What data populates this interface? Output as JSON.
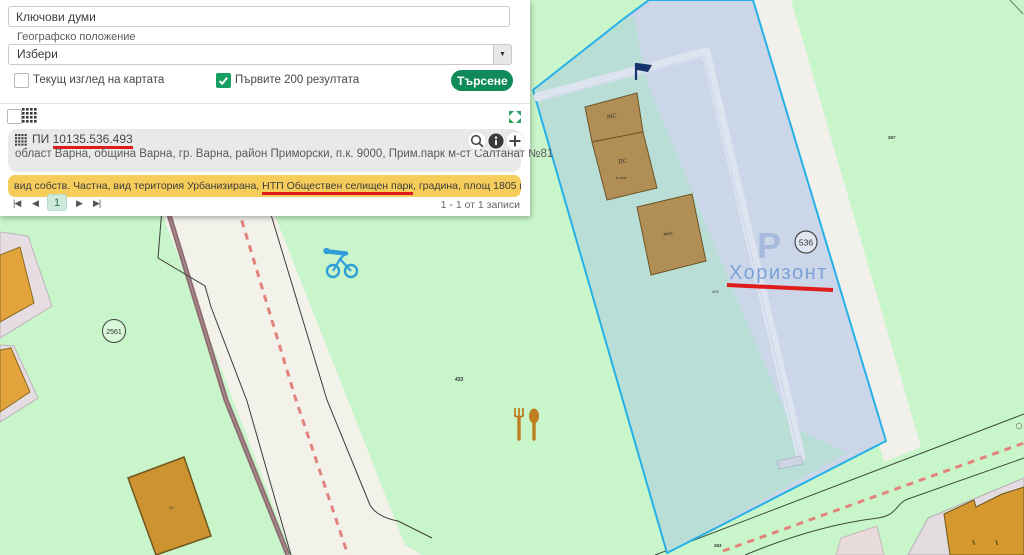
{
  "colors": {
    "accent_green": "#0f8a58",
    "selection_blue_fill": "#cbd7e9",
    "selection_border_cyan": "#25b1e8",
    "highlight_yellow": "#f6cd5b",
    "annotation_red": "#e01b1b",
    "map_background_green": "#c9f5ca"
  },
  "search_panel": {
    "keywords_value": "Ключови думи",
    "geo_label": "Географско положение",
    "geo_value": "Избери",
    "dropdown_glyph": "▼",
    "checkbox_current_view": "Текущ изглед на картата",
    "checkbox_first_results": "Първите 200 резултата",
    "search_button": "Търсене"
  },
  "results": {
    "id_prefix": "ПИ ",
    "id_number": "10135.536.493",
    "address": "област Варна, община Варна, гр. Варна, район Приморски, п.к. 9000, Прим.парк м-ст Салтанат №81",
    "details_before": "вид собств. Частна, вид територия Урбанизирана, ",
    "details_marked": "НТП Обществен селищен парк",
    "details_after": ", градина, площ 1805 кв. м, квартал 0",
    "pagination": {
      "first": "|◀",
      "prev": "◀",
      "page": "1",
      "next": "▶",
      "last": "▶|",
      "summary": "1 - 1 от 1 записи"
    }
  },
  "map": {
    "labels": {
      "parcel_big": "536",
      "horizon": "Хоризонт",
      "parking": "P",
      "parcel_2561": "2561",
      "n267": "267",
      "n433": "433",
      "n493": "493",
      "n263": "263",
      "n31": "31",
      "bld_ms": "МС",
      "bld_ps": "ПС",
      "bld_ps2": "п.зав",
      "bld_mag": "маг"
    }
  }
}
